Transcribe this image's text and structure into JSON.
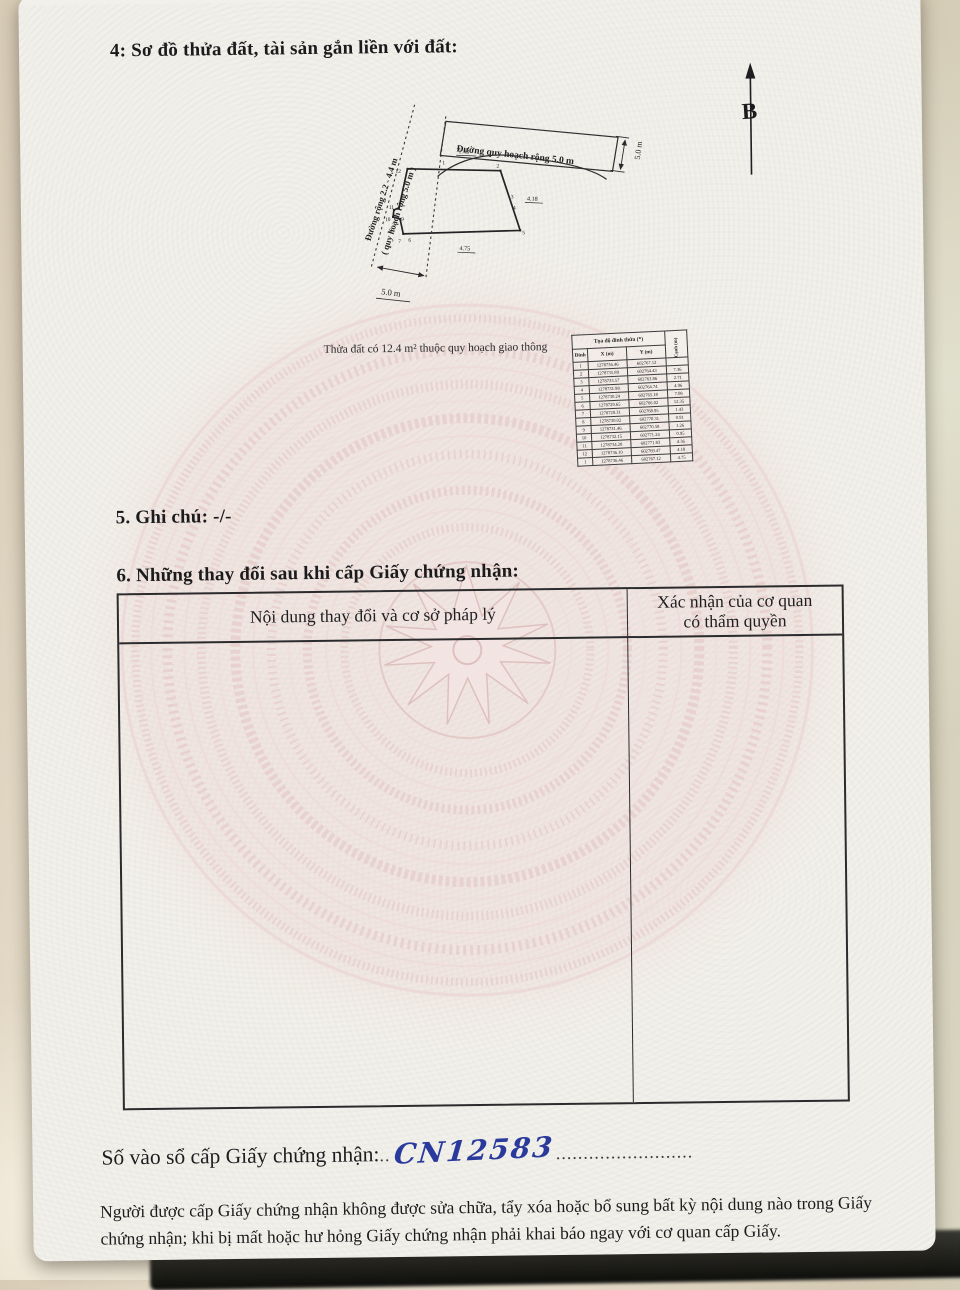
{
  "colors": {
    "paper": "#f2f0ea",
    "pattern_pink": "#e9d2d0",
    "ink": "#1c1c1e",
    "handwriting_blue": "#2a3a9c"
  },
  "document": {
    "section4_title": "4: Sơ đồ thửa đất, tài sản gắn liền với đất:",
    "section5_text": "5. Ghi chú: -/-",
    "section6_title": "6. Những thay đổi sau khi cấp Giấy chứng nhận:",
    "changes_table": {
      "col1_header": "Nội dung thay đổi và cơ sở pháp lý",
      "col2_header_line1": "Xác nhận của cơ quan",
      "col2_header_line2": "có thẩm quyền"
    },
    "book_entry_label": "Số vào sổ cấp Giấy chứng nhận:",
    "dots_before": "..",
    "book_entry_value": "CN12583",
    "dots_after": ".........................",
    "footer_text": "Người được cấp Giấy chứng nhận không được sửa chữa, tẩy xóa hoặc bổ sung bất kỳ nội dung nào trong Giấy chứng nhận; khi bị mất hoặc hư hỏng Giấy chứng nhận phải khai báo ngay với cơ quan cấp Giấy."
  },
  "diagram": {
    "north_label": "B",
    "note": "Thửa đất có 12.4 m²  thuộc quy hoạch giao thông",
    "road_top_label": "Đường quy hoạch rộng 5.0 m",
    "road_top_width": "5.0 m",
    "road_left_label_1": "Đường rộng 2.2 - 4.4 m",
    "road_left_label_2": "( quy hoạch rộng 5.0 m )",
    "road_left_width": "5.0 m",
    "dims": {
      "top": "1.43",
      "right": "4.18",
      "bottom": "4.75"
    },
    "vertex_labels": [
      "1",
      "2",
      "3",
      "4",
      "5",
      "6",
      "7",
      "8",
      "9",
      "10",
      "11",
      "12"
    ]
  },
  "coord_table": {
    "title": "Tọa độ đỉnh thửa (*)",
    "col_vertex": "Đỉnh",
    "col_x": "X (m)",
    "col_y": "Y (m)",
    "col_edge": "Cạnh (m)",
    "rows": [
      {
        "v": "1",
        "x": "1278736.46",
        "y": "602767.12",
        "e": ""
      },
      {
        "v": "2",
        "x": "1278735.89",
        "y": "602764.43",
        "e": "7.36"
      },
      {
        "v": "3",
        "x": "1278733.57",
        "y": "602763.86",
        "e": "2.71"
      },
      {
        "v": "4",
        "x": "1278731.98",
        "y": "602764.74",
        "e": "4.96"
      },
      {
        "v": "5",
        "x": "1278730.24",
        "y": "602765.18",
        "e": "7.08"
      },
      {
        "v": "6",
        "x": "1278729.65",
        "y": "602766.02",
        "e": "12.35"
      },
      {
        "v": "7",
        "x": "1278729.31",
        "y": "602768.95",
        "e": "1.43"
      },
      {
        "v": "8",
        "x": "1278730.02",
        "y": "602770.31",
        "e": "0.91"
      },
      {
        "v": "9",
        "x": "1278731.46",
        "y": "602770.58",
        "e": "1.26"
      },
      {
        "v": "10",
        "x": "1278732.15",
        "y": "602771.24",
        "e": "0.95"
      },
      {
        "v": "11",
        "x": "1278734.28",
        "y": "602771.83",
        "e": "4.36"
      },
      {
        "v": "12",
        "x": "1278736.10",
        "y": "602769.47",
        "e": "4.18"
      },
      {
        "v": "1",
        "x": "1278736.46",
        "y": "602767.12",
        "e": "4.75"
      }
    ]
  }
}
